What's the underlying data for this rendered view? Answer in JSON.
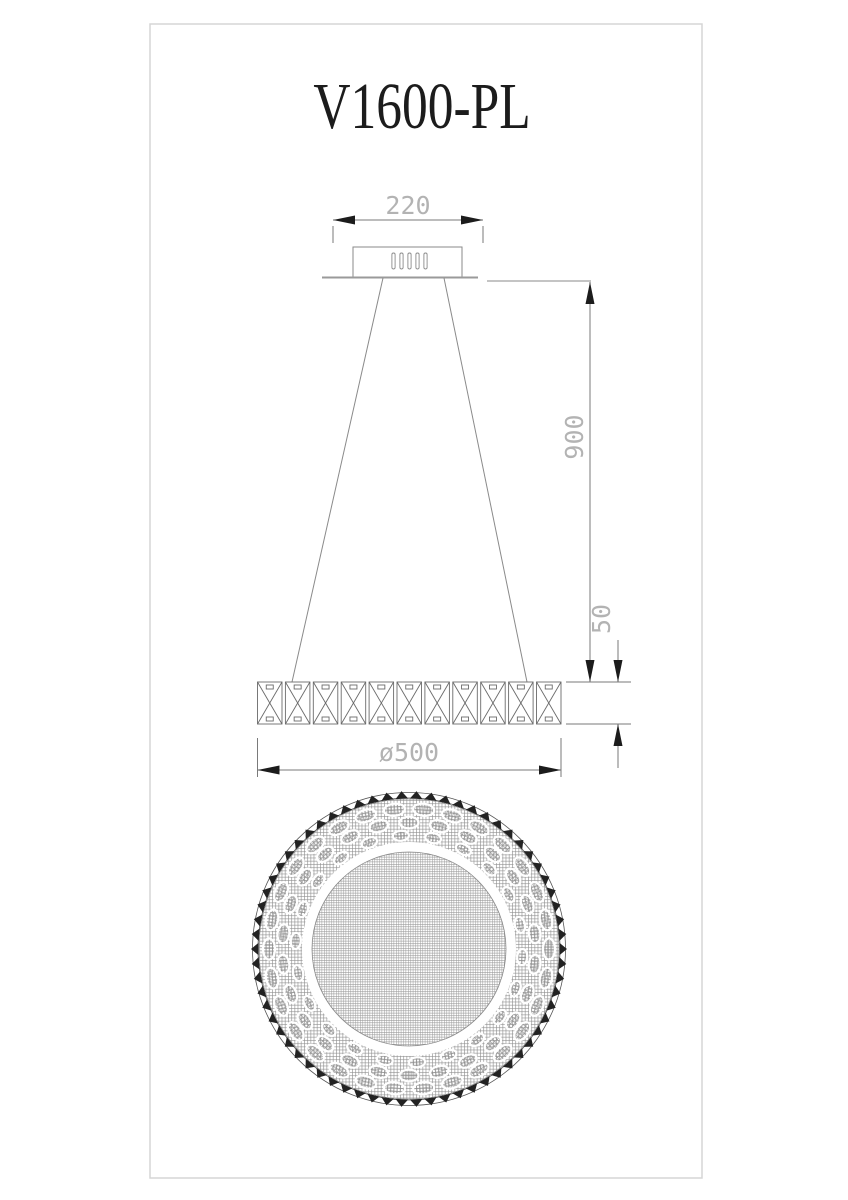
{
  "title": "V1600-PL",
  "dims": {
    "canopy_width": "220",
    "drop": "900",
    "ring_height": "50",
    "diameter": "ø500"
  },
  "side_view": {
    "slot_count": 5,
    "segment_count": 11
  },
  "bottom_view": {
    "bead_count": 66,
    "oval_rows": [
      {
        "count": 30,
        "r": 140,
        "rt": 10.5,
        "rr": 6,
        "offset": 0
      },
      {
        "count": 26,
        "r": 126.5,
        "rt": 9.5,
        "rr": 5.8,
        "offset": 0.5
      },
      {
        "count": 22,
        "r": 113.5,
        "rt": 8,
        "rr": 5,
        "offset": 0.25
      }
    ]
  },
  "colors": {
    "frame": "#d6d6d6",
    "line": "#8a8a8a",
    "segment_line": "#6b6b6b",
    "dim_line": "#7a7a7a",
    "dim_text": "#b3b3b3",
    "arrow": "#1c1c1c",
    "hatch": "#8d8d8d"
  }
}
